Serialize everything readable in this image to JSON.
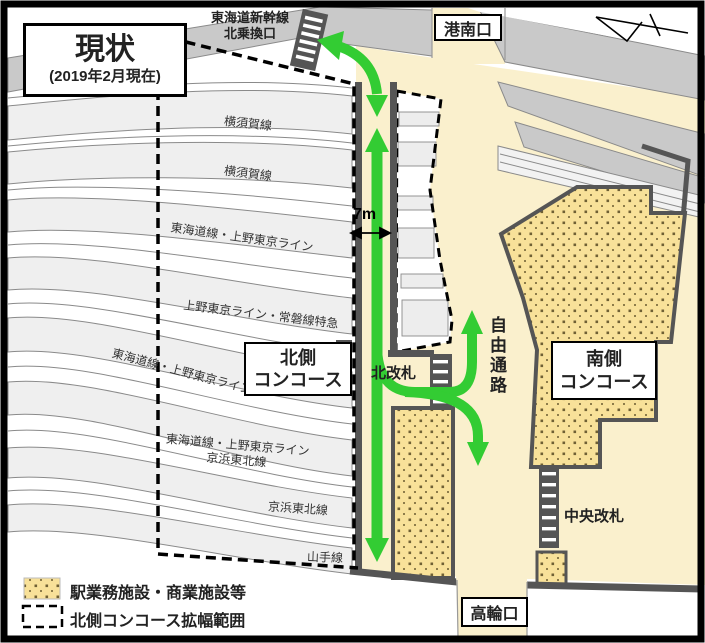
{
  "title": {
    "heading": "現状",
    "subtitle": "(2019年2月現在)"
  },
  "exits": {
    "konan": "港南口",
    "takanawa": "高輪口"
  },
  "gates": {
    "shinkansen": [
      "東海道新幹線",
      "北乗換口"
    ],
    "north": "北改札",
    "central": "中央改札"
  },
  "concourses": {
    "north": [
      "北側",
      "コンコース"
    ],
    "south": [
      "南側",
      "コンコース"
    ]
  },
  "passage": {
    "free_passage": "自由通路",
    "corridor_width": "7m"
  },
  "tracks": [
    {
      "label": "横須賀線"
    },
    {
      "label": "横須賀線"
    },
    {
      "label": "東海道線・上野東京ライン"
    },
    {
      "label": "上野東京ライン・常磐線特急"
    },
    {
      "label": "東海道線・上野東京ライン"
    },
    {
      "label": "東海道線・上野東京ライン",
      "label2": "京浜東北線"
    },
    {
      "label": "京浜東北線"
    },
    {
      "label": "山手線"
    }
  ],
  "legend": {
    "facilities": "駅業務施設・商業施設等",
    "expansion": "北側コンコース拡幅範囲"
  },
  "colors": {
    "passage_cream": "#FAF0CD",
    "facility_fill": "#F8E199",
    "facility_dot": "#6F6034",
    "platform_gray": "#EFEFEF",
    "viaduct_gray": "#C9C9C9",
    "wall_dark": "#555555",
    "arrow_green": "#33CC33"
  }
}
